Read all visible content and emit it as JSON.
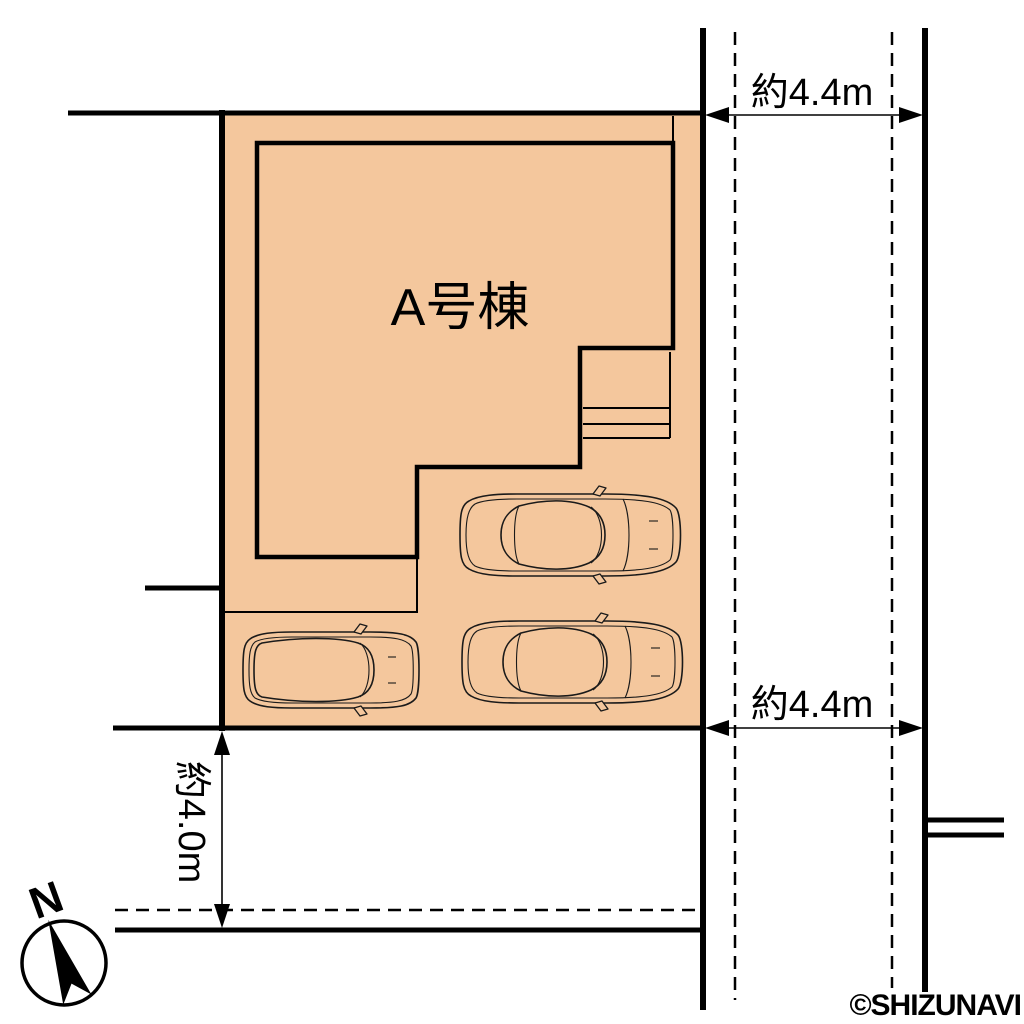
{
  "plan": {
    "building_label": "A号棟",
    "dimensions": {
      "east_road_top": "約4.4m",
      "east_road_bottom": "約4.4m",
      "south_road": "約4.0m"
    },
    "compass_label": "N",
    "watermark": "©SHIZUNAVI",
    "colors": {
      "lot_fill": "#F4C79D",
      "line": "#000000",
      "watermark_color": "#3C3C3C"
    }
  }
}
